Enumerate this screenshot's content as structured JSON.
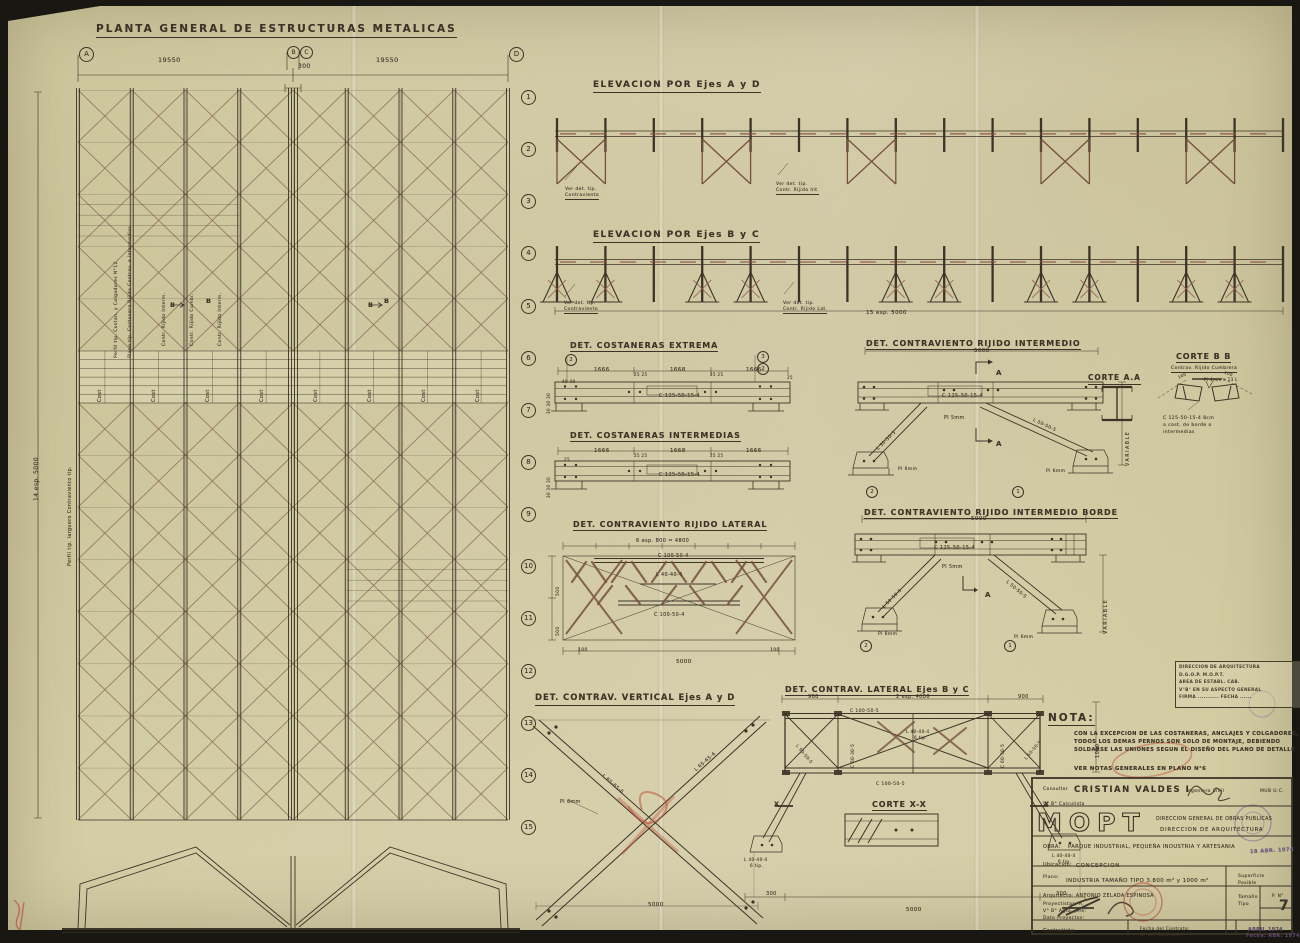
{
  "plan": {
    "title": "PLANTA GENERAL DE ESTRUCTURAS METALICAS",
    "dim_left": "19550",
    "dim_right": "19550",
    "dim_center": "300",
    "axis_a": "A",
    "axis_b": "B",
    "axis_c": "C",
    "axis_d": "D",
    "rows": [
      "1",
      "2",
      "3",
      "4",
      "5",
      "6",
      "7",
      "8",
      "9",
      "10",
      "11",
      "12",
      "13",
      "14",
      "15"
    ],
    "left_dim": "14 esp. 5000",
    "left_note": "Perfil tip. larguero Contraviento tip.",
    "cost_label": "Cost",
    "ann1": "Perfil tip. Costan. y Colgadores N°12",
    "ann2": "Plano tip. Costanera Ríjida Contrav. e intermedias",
    "ann3": "Contr. Ríjido Interm.",
    "ann4": "Contr. Ríjido Cumbr.",
    "ann5": "Contr. Ríjido Interm.",
    "section_b": "B"
  },
  "elev_ad": {
    "title": "ELEVACION POR Ejes A y D",
    "note1a": "Ver det. tip.",
    "note1b": "Contraviento",
    "note2a": "Ver det. tip.",
    "note2b": "Contr. Ríjido Int."
  },
  "elev_bc": {
    "title": "ELEVACION POR Ejes B y C",
    "note1a": "Ver det. tip.",
    "note1b": "Contraviento",
    "note2a": "Ver det. tip.",
    "note2b": "Contr. Ríjido Lat.",
    "dim": "15 esp. 5000"
  },
  "cost_ext": {
    "title": "DET. COSTANERAS  EXTREMA",
    "d1": "1666",
    "d2": "1668",
    "d3": "1666",
    "s40": "40  40",
    "s25": "25  25",
    "s25b": "25",
    "profile": "C 125-50-15-4",
    "side": "30 30 30",
    "m2": "2",
    "m3": "3"
  },
  "cost_int": {
    "title": "DET. COSTANERAS INTERMEDIAS"
  },
  "cr_lat": {
    "title": "DET.  CONTRAVIENTO RIJIDO LATERAL",
    "top_dim": "6 esp. 800 = 4800",
    "chord_top": "C 100-50-4",
    "mid": "L 40-40-4",
    "chord_bot": "C 100-50-4",
    "bot_dim": "5000",
    "c100": "100",
    "v500": "500"
  },
  "cr_int": {
    "title": "DET. CONTRAVIENTO RIJIDO INTERMEDIO",
    "dim": "5000",
    "profile": "C 125-50-15-4",
    "pl5": "Pl 5mm",
    "diag": "L 50-50-5",
    "pl6": "Pl 6mm",
    "sec": "A",
    "m1": "1",
    "m2": "2",
    "variable": "VARIABLE"
  },
  "corte_aa": {
    "title": "CORTE A.A"
  },
  "corte_bb": {
    "title": "CORTE  B B",
    "subtitle": "Contrav. Ríjido Cumbrera",
    "d100": "100",
    "pl": "Pl 4mm e 13 L",
    "note1": "C 125-50-15-4  8cm",
    "note2": "a cost. de borde o",
    "note3": "intermedias"
  },
  "cr_borde": {
    "title": "DET. CONTRAVIENTO RIJIDO INTERMEDIO  BORDE"
  },
  "cv_vert": {
    "title": "DET. CONTRAV. VERTICAL  Ejes A y D",
    "m1": "L 65-65-6",
    "pl": "Pl 6mm",
    "dim": "5000"
  },
  "cl_bc": {
    "title": "DET. CONTRAV. LATERAL  Ejes B y C",
    "d900": "900",
    "d2": "2 esp. 4000",
    "chord": "C 100-50-5",
    "m40": "L 40-40-4",
    "m40b": "6 tip.",
    "m50": "L 50-50-5",
    "m60": "C 60-30-5",
    "v1000": "1000",
    "b300": "300",
    "b5000": "5000",
    "sec": "X"
  },
  "corte_xx": {
    "title": "CORTE  X-X"
  },
  "nota": {
    "heading": "NOTA:",
    "line1": "CON LA EXCEPCION DE LAS COSTANERAS, ANCLAJES Y COLGADORES,",
    "line2": "TODOS LOS DEMAS PERNOS SON SOLO DE MONTAJE, DEBIENDO",
    "line3": "SOLDARSE LAS UNIONES SEGUN EL DISEÑO DEL PLANO DE DETALLE",
    "see": "VER NOTAS GENERALES EN PLANO N°6"
  },
  "stamp": {
    "l1": "DIRECCION DE ARQUITECTURA",
    "l2": "D.G.O.P.         M.O.P.T.",
    "l3": "AREA DE ESTABL. CAB.",
    "l4": "V°B° EN SU ASPECTO GENERAL",
    "l5": "FIRMA ........... FECHA ......"
  },
  "tb": {
    "consultor_label": "Consultor",
    "consultor": "CRISTIAN VALDES I",
    "role": "Ingeniero Civil",
    "univ": "MUB U.C.",
    "vobo": "V° B°    Calculista",
    "logo": "MOPT",
    "dept1": "DIRECCION GENERAL DE OBRAS PUBLICAS",
    "dept2": "DIRECCION  DE  ARQUITECTURA",
    "obra_label": "OBRA:",
    "obra": "PARQUE INDUSTRIAL, PEQUEÑA INDUSTRIA Y ARTESANIA",
    "date_stamp": "18 ABR. 1974",
    "ubicacion_label": "Ubicacion:",
    "ubicacion": "CONCEPCION",
    "plano_label": "Plano:",
    "plano": "INDUSTRIA TAMAÑO TIPO 3.800 m² y 1000 m²",
    "superficie1": "Superficie",
    "superficie2": "Posible",
    "arquitecto": "Arquitecto:  ANTONIO ZELADA ESPINOSA",
    "proyectistas": "Proyectistas:          A.",
    "vobo2": "V° B° Agto. jefe:",
    "dato": "Dato  Proyectos:",
    "tamano1": "Tamaño",
    "tamano2": "Tipo",
    "pn_label": "P.  N°",
    "pn": "7",
    "contratista": "Contratista:",
    "fecha1": "Fecha   del  Contrato:",
    "fecha2": "N°        del  Contrato",
    "date1": "ABRIL 1974",
    "date2": "Fecha: ABR. 1974"
  }
}
